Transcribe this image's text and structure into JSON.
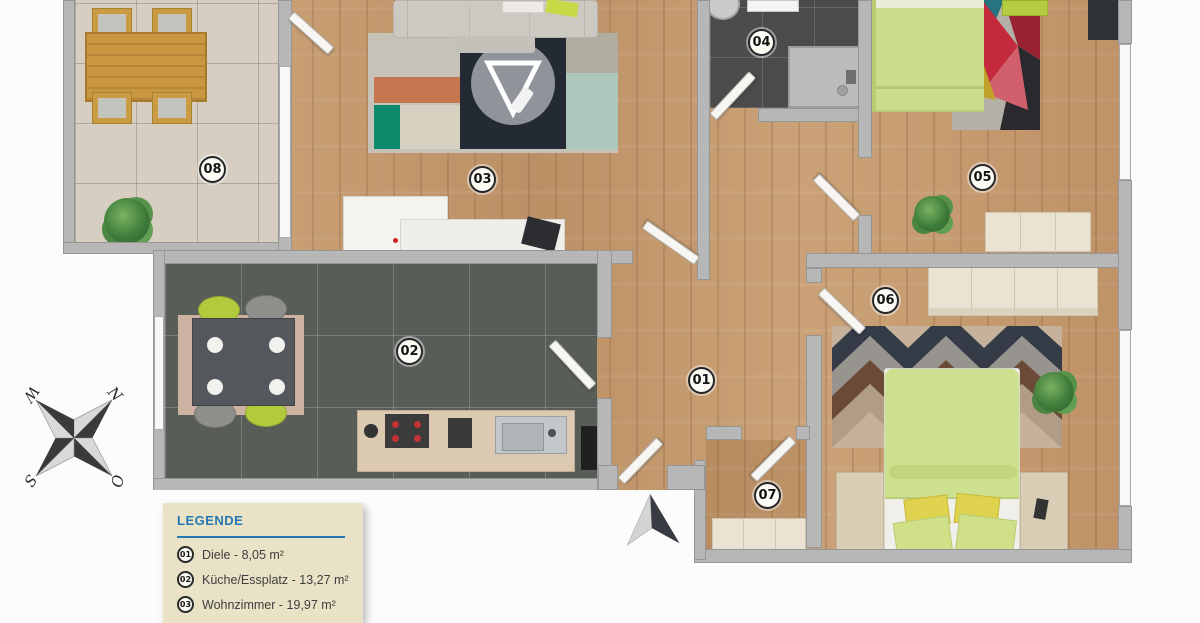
{
  "plan": {
    "rooms": [
      {
        "number": "01"
      },
      {
        "number": "02"
      },
      {
        "number": "03"
      },
      {
        "number": "04"
      },
      {
        "number": "05"
      },
      {
        "number": "06"
      },
      {
        "number": "07"
      },
      {
        "number": "08"
      }
    ]
  },
  "legend": {
    "title": "LEGENDE",
    "items": [
      {
        "number": "01",
        "label": "Diele - 8,05 m²"
      },
      {
        "number": "02",
        "label": "Küche/Essplatz - 13,27 m²"
      },
      {
        "number": "03",
        "label": "Wohnzimmer - 19,97 m²"
      }
    ]
  },
  "compass": {
    "north": "N",
    "east": "O",
    "south": "S",
    "west": "W"
  },
  "colors": {
    "wood_floor": "#c69b6f",
    "kitchen_tile": "#585d58",
    "bath_tile": "#4b4b4b",
    "terrace_tile": "#d6cfc1",
    "wall_gray": "#b7b7b7",
    "accent_lime": "#cbdd8c",
    "legend_bg": "#e9e2c7",
    "legend_title_blue": "#2579b2"
  }
}
